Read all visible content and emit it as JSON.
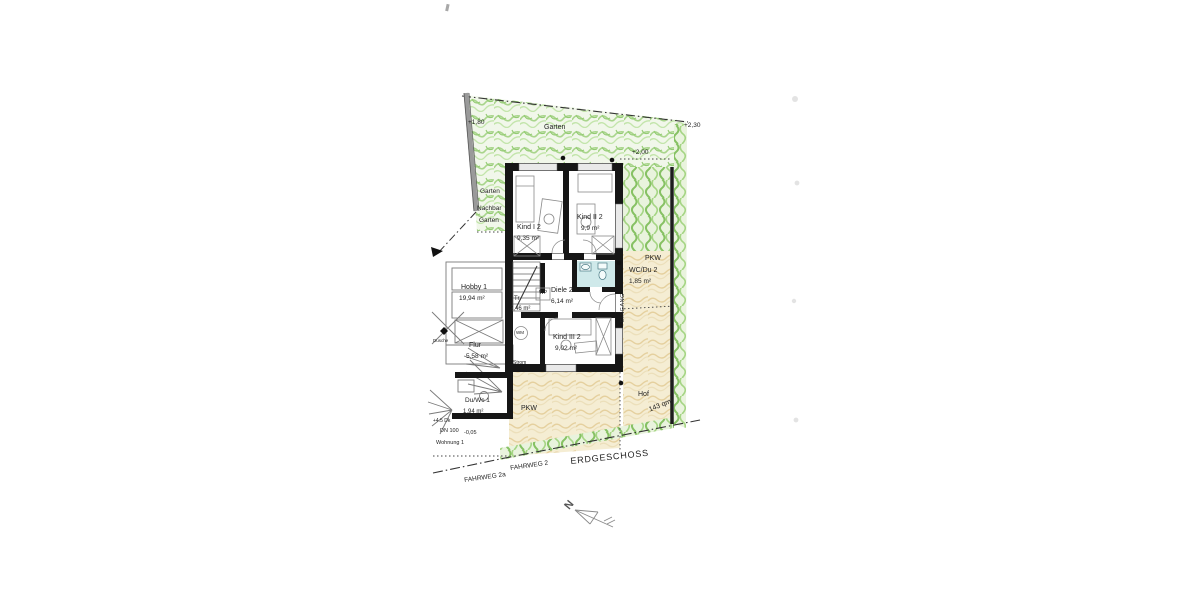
{
  "drawing": {
    "floor_label": "ERDGESCHOSS",
    "north_label": "N"
  },
  "site": {
    "garden_top": "Garten",
    "garden_left": "Garten",
    "neighbor_garden_line1": "Nachbar",
    "neighbor_garden_line2": "Garten",
    "court_label": "Hof",
    "court_area": "143 qm",
    "parking_right": "PKW",
    "parking_bottom": "PKW",
    "entrance": "EINGANG",
    "road_1": "FAHRWEG 2",
    "road_2": "FAHRWEG 2a"
  },
  "levels": {
    "garden_upper": "+1,80",
    "garden_right": "+2,30",
    "terrace": "+2,00",
    "entry": "-0,05",
    "roof_note": "+4.5 Dk",
    "drain": "DN 100",
    "unit": "Wohnung 1"
  },
  "rooms": [
    {
      "name": "Kind I 2",
      "area": "9,35 m²"
    },
    {
      "name": "Kind II 2",
      "area": "9,9 m²"
    },
    {
      "name": "Hobby 1",
      "area": "19,94 m²"
    },
    {
      "name": "Tr.",
      "area": "2,46 m²"
    },
    {
      "name": "Diele 2",
      "area": "6,14 m²"
    },
    {
      "name": "Kind III 2",
      "area": "9,02 m²"
    },
    {
      "name": "WC/Du 2",
      "area": "1,85 m²"
    },
    {
      "name": "Flur",
      "area": "5,58 m²"
    },
    {
      "name": "Du/Wc 1",
      "area": "1,94 m²"
    }
  ],
  "fixtures": {
    "washing_machine": "WM",
    "heat_pump": "WP",
    "power": "Strom",
    "shower": "Dusche"
  },
  "colors": {
    "garden_green": "#a9d58c",
    "hedge_green": "#86c163",
    "court_tan": "#e5d09e",
    "wall_black": "#161616",
    "bath_blue": "#cfe9ea"
  }
}
